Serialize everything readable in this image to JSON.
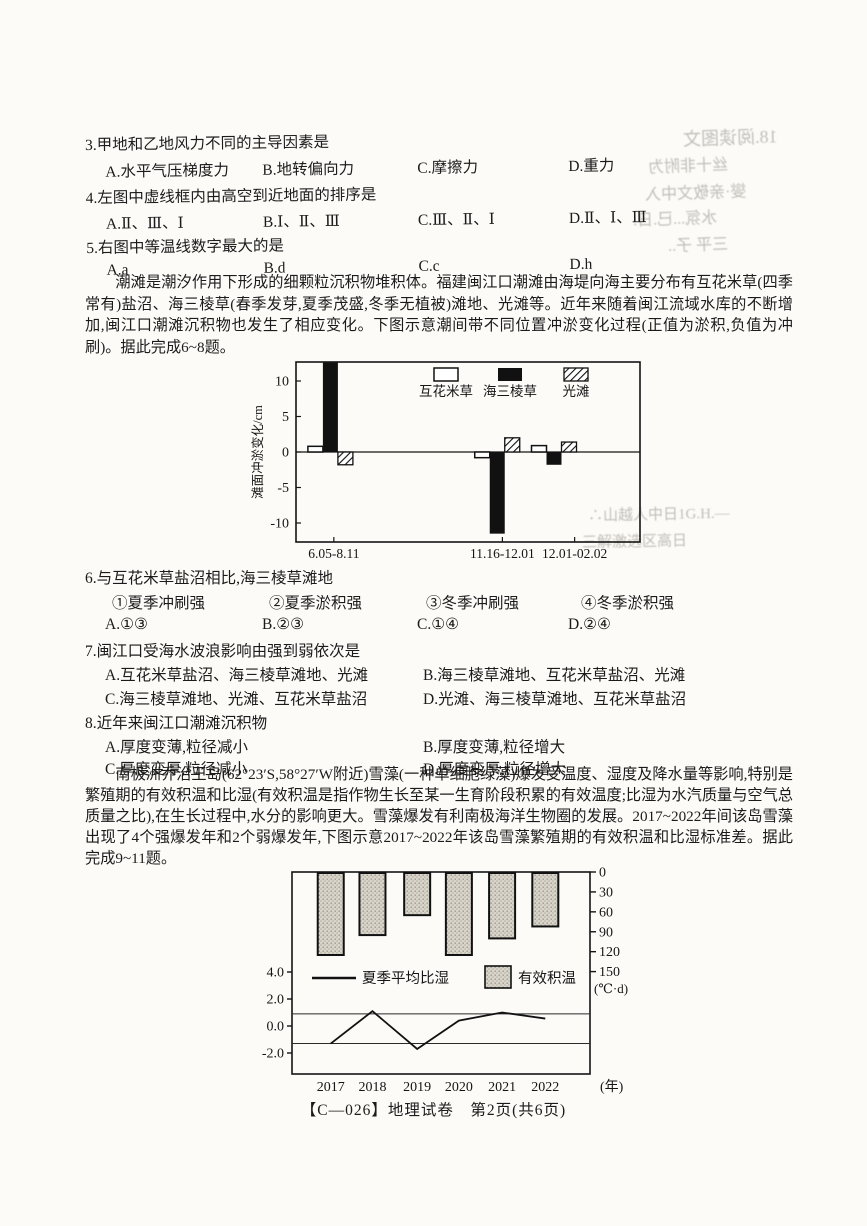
{
  "page": {
    "footer": "【C—026】地理试卷　第2页(共6页)"
  },
  "questions": {
    "q3": {
      "stem": "3.甲地和乙地风力不同的主导因素是",
      "options": [
        "A.水平气压梯度力",
        "B.地转偏向力",
        "C.摩擦力",
        "D.重力"
      ]
    },
    "q4": {
      "stem": "4.左图中虚线框内由高空到近地面的排序是",
      "options": [
        "A.Ⅱ、Ⅲ、Ⅰ",
        "B.Ⅰ、Ⅱ、Ⅲ",
        "C.Ⅲ、Ⅱ、Ⅰ",
        "D.Ⅱ、Ⅰ、Ⅲ"
      ]
    },
    "q5": {
      "stem": "5.右图中等温线数字最大的是",
      "options": [
        "A.a",
        "B.d",
        "C.c",
        "D.h"
      ]
    },
    "q6": {
      "stem": "6.与互花米草盐沼相比,海三棱草滩地",
      "sub_options": [
        "①夏季冲刷强",
        "②夏季淤积强",
        "③冬季冲刷强",
        "④冬季淤积强"
      ],
      "options": [
        "A.①③",
        "B.②③",
        "C.①④",
        "D.②④"
      ]
    },
    "q7": {
      "stem": "7.闽江口受海水波浪影响由强到弱依次是",
      "options": [
        "A.互花米草盐沼、海三棱草滩地、光滩",
        "B.海三棱草滩地、互花米草盐沼、光滩",
        "C.海三棱草滩地、光滩、互花米草盐沼",
        "D.光滩、海三棱草滩地、互花米草盐沼"
      ]
    },
    "q8": {
      "stem": "8.近年来闽江口潮滩沉积物",
      "options": [
        "A.厚度变薄,粒径减小",
        "B.厚度变薄,粒径增大",
        "C.厚度变厚,粒径减小",
        "D.厚度变厚,粒径增大"
      ]
    }
  },
  "passages": {
    "tidal_flat": "潮滩是潮汐作用下形成的细颗粒沉积物堆积体。福建闽江口潮滩由海堤向海主要分布有互花米草(四季常有)盐沼、海三棱草(春季发芽,夏季茂盛,冬季无植被)滩地、光滩等。近年来随着闽江流域水库的不断增加,闽江口潮滩沉积物也发生了相应变化。下图示意潮间带不同位置冲淤变化过程(正值为淤积,负值为冲刷)。据此完成6~8题。",
    "snow_algae": "南极洲乔治王岛(62°23′S,58°27′W附近)雪藻(一种单细胞绿藻)爆发受温度、湿度及降水量等影响,特别是繁殖期的有效积温和比湿(有效积温是指作物生长至某一生育阶段积累的有效温度;比湿为水汽质量与空气总质量之比),在生长过程中,水分的影响更大。雪藻爆发有利南极海洋生物圈的发展。2017~2022年间该岛雪藻出现了4个强爆发年和2个弱爆发年,下图示意2017~2022年该岛雪藻繁殖期的有效积温和比湿标准差。据此完成9~11题。"
  },
  "chart_data": [
    {
      "type": "bar",
      "title": "",
      "ylabel": "滩面冲淤变化/cm",
      "ylim": [
        -12.7,
        12.7
      ],
      "yticks": [
        10,
        5,
        0,
        -5,
        -10
      ],
      "categories": [
        "6.05-8.11",
        "11.16-12.01",
        "12.01-02.02"
      ],
      "series": [
        {
          "name": "互花米草",
          "style": "open",
          "values": [
            0.8,
            -0.8,
            0.9
          ]
        },
        {
          "name": "海三棱草",
          "style": "solid",
          "values": [
            12.6,
            -11.5,
            -1.8
          ]
        },
        {
          "name": "光滩",
          "style": "hatched",
          "values": [
            -1.8,
            2.0,
            1.4
          ]
        }
      ],
      "group_centers": [
        0.1,
        0.585,
        0.75
      ],
      "label_centers": [
        0.11,
        0.6,
        0.81
      ],
      "legend_position": "top-inside",
      "grid": false
    },
    {
      "type": "bar+line",
      "categories": [
        "2017",
        "2018",
        "2019",
        "2020",
        "2021",
        "2022"
      ],
      "x_suffix": "(年)",
      "bar_series": {
        "name": "有效积温",
        "axis": "right",
        "values": [
          125,
          95,
          65,
          125,
          100,
          82
        ]
      },
      "line_series": {
        "name": "夏季平均比湿",
        "axis": "left",
        "values": [
          -1.3,
          1.1,
          -1.7,
          0.4,
          1.0,
          0.55
        ]
      },
      "left_ticks": [
        "4.0",
        "2.0",
        "0.0",
        "-2.0"
      ],
      "left_tick_values": [
        4,
        2,
        0,
        -2
      ],
      "right_ticks": [
        0,
        30,
        60,
        90,
        120,
        150
      ],
      "right_axis_unit": "(℃·d)",
      "reference_lines": [
        0.9,
        -1.3
      ],
      "bars_hang_from_top": true,
      "grid": false
    }
  ],
  "bleedthrough": {
    "items": [
      {
        "text": "18.阅读图文"
      },
      {
        "text": "丝十非附为"
      },
      {
        "text": "燮·亲敬文中入"
      },
      {
        "text": "水氛...已.日."
      },
      {
        "text": "三平 子.."
      },
      {
        "text": "∴山越人中日1G.H.—"
      },
      {
        "text": "三解激选区高日"
      }
    ]
  }
}
